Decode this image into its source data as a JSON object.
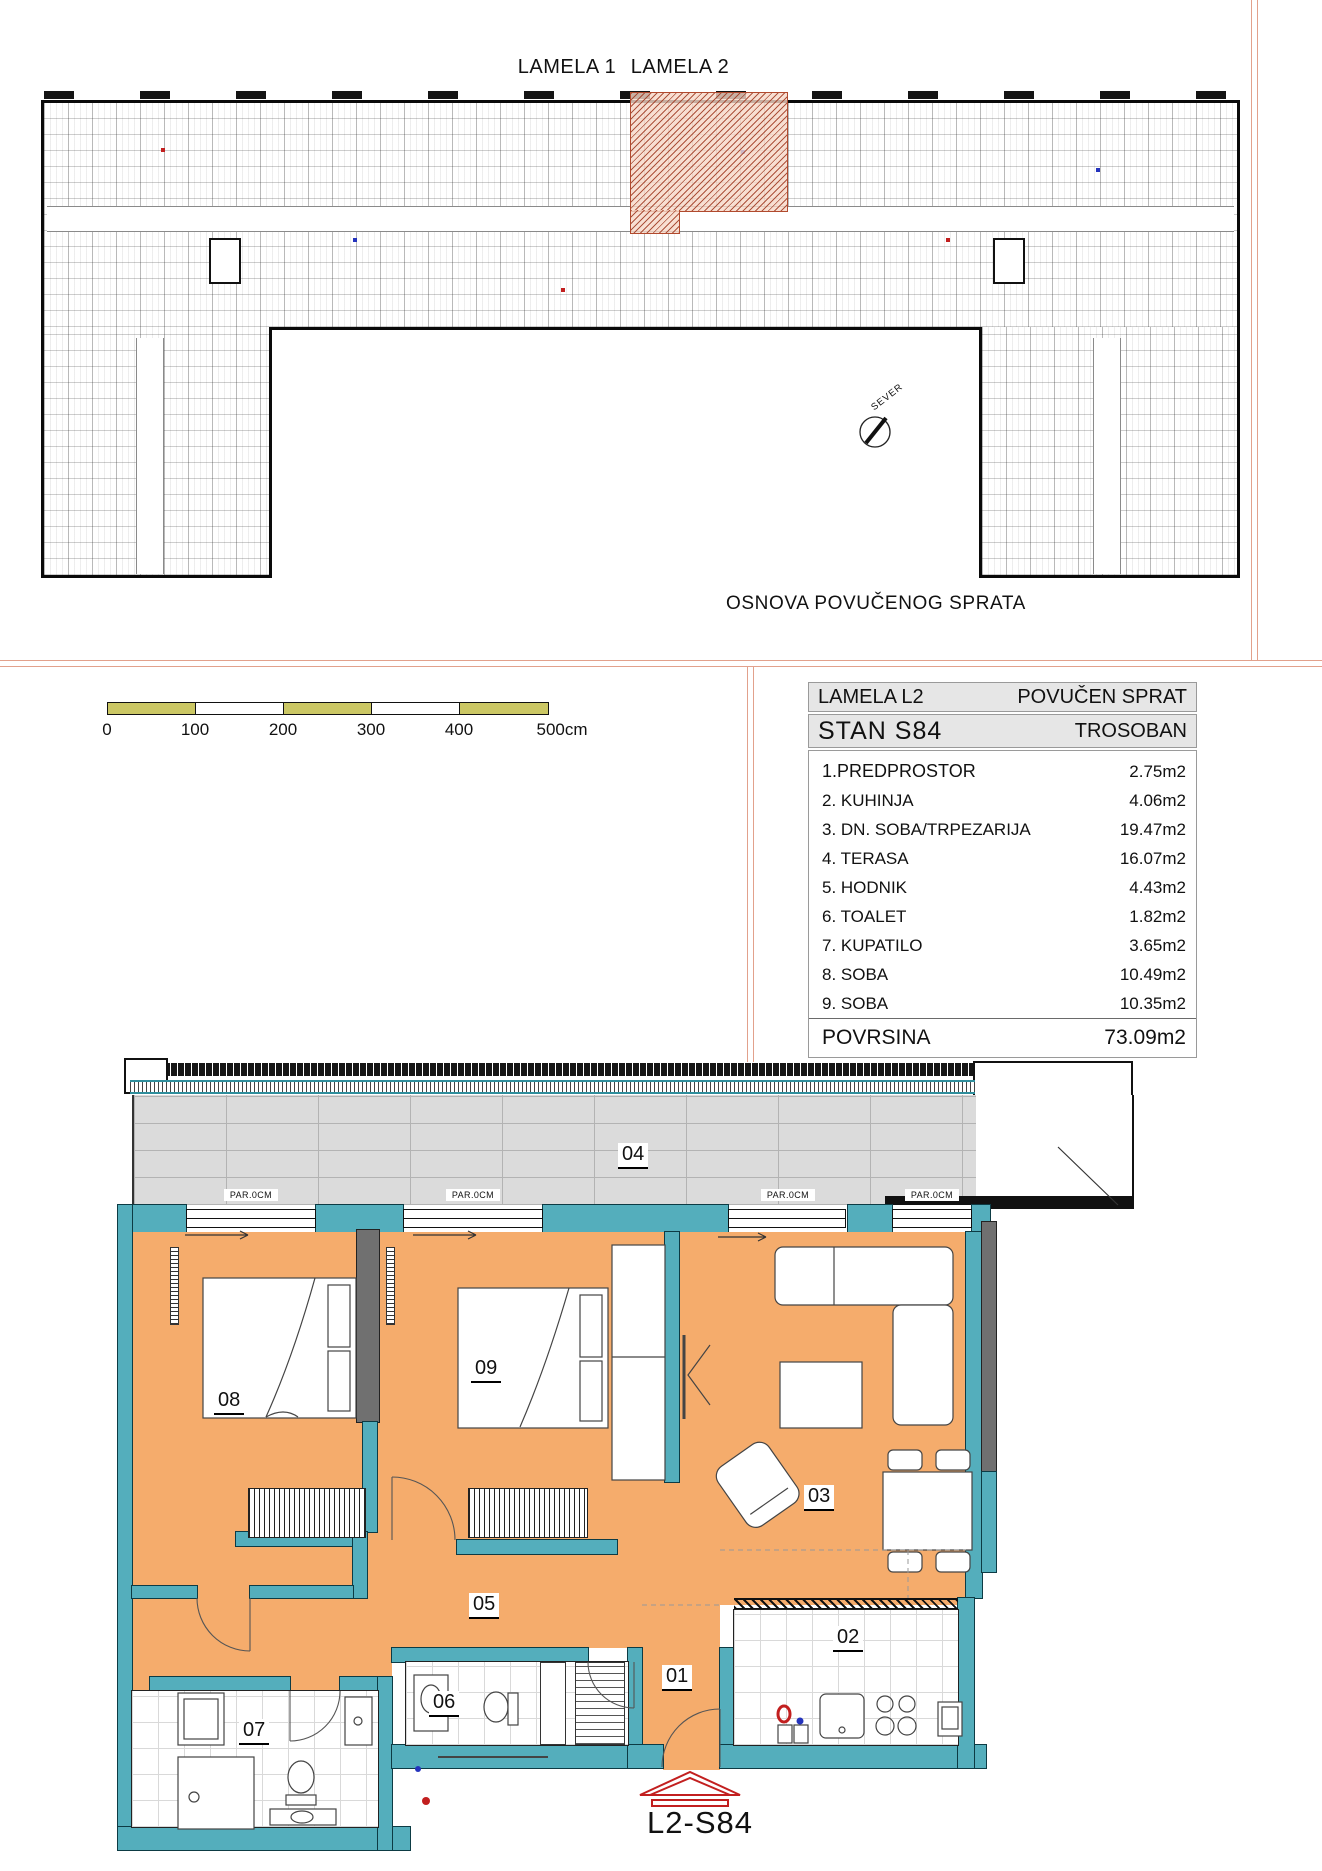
{
  "page": {
    "lamela1": "LAMELA 1",
    "lamela2": "LAMELA 2",
    "drawing_title": "OSNOVA POVUČENOG SPRATA",
    "north_label": "SEVER"
  },
  "scale_bar": {
    "labels": [
      "0",
      "100",
      "200",
      "300",
      "400",
      "500cm"
    ]
  },
  "info_table": {
    "lamela": "LAMELA L2",
    "sprat": "POVUČEN SPRAT",
    "stan": "STAN S84",
    "tip": "TROSOBAN",
    "rooms": [
      {
        "name": "1.PREDPROSTOR",
        "area": "2.75m2"
      },
      {
        "name": "2. KUHINJA",
        "area": "4.06m2"
      },
      {
        "name": "3. DN. SOBA/TRPEZARIJA",
        "area": "19.47m2"
      },
      {
        "name": "4. TERASA",
        "area": "16.07m2"
      },
      {
        "name": "5. HODNIK",
        "area": "4.43m2"
      },
      {
        "name": "6. TOALET",
        "area": "1.82m2"
      },
      {
        "name": "7. KUPATILO",
        "area": "3.65m2"
      },
      {
        "name": "8. SOBA",
        "area": "10.49m2"
      },
      {
        "name": "9. SOBA",
        "area": "10.35m2"
      }
    ],
    "total_label": "POVRSINA",
    "total_area": "73.09m2"
  },
  "plan": {
    "unit_label": "L2-S84",
    "parapet_label": "PAR.0CM",
    "room_numbers": {
      "r01": "01",
      "r02": "02",
      "r03": "03",
      "r04": "04",
      "r05": "05",
      "r06": "06",
      "r07": "07",
      "r08": "08",
      "r09": "09"
    }
  },
  "colors": {
    "floor_orange": "#F5AC6C",
    "wall_teal": "#54AEBC",
    "wall_gray": "#707070",
    "terrace_gray": "#DBDBDB",
    "scalebar_olive": "#CBC764",
    "frame_salmon": "#E2A18C",
    "highlight_hatch": "#B14A2E",
    "accent_red": "#C21F1F",
    "accent_blue": "#2433BD"
  }
}
